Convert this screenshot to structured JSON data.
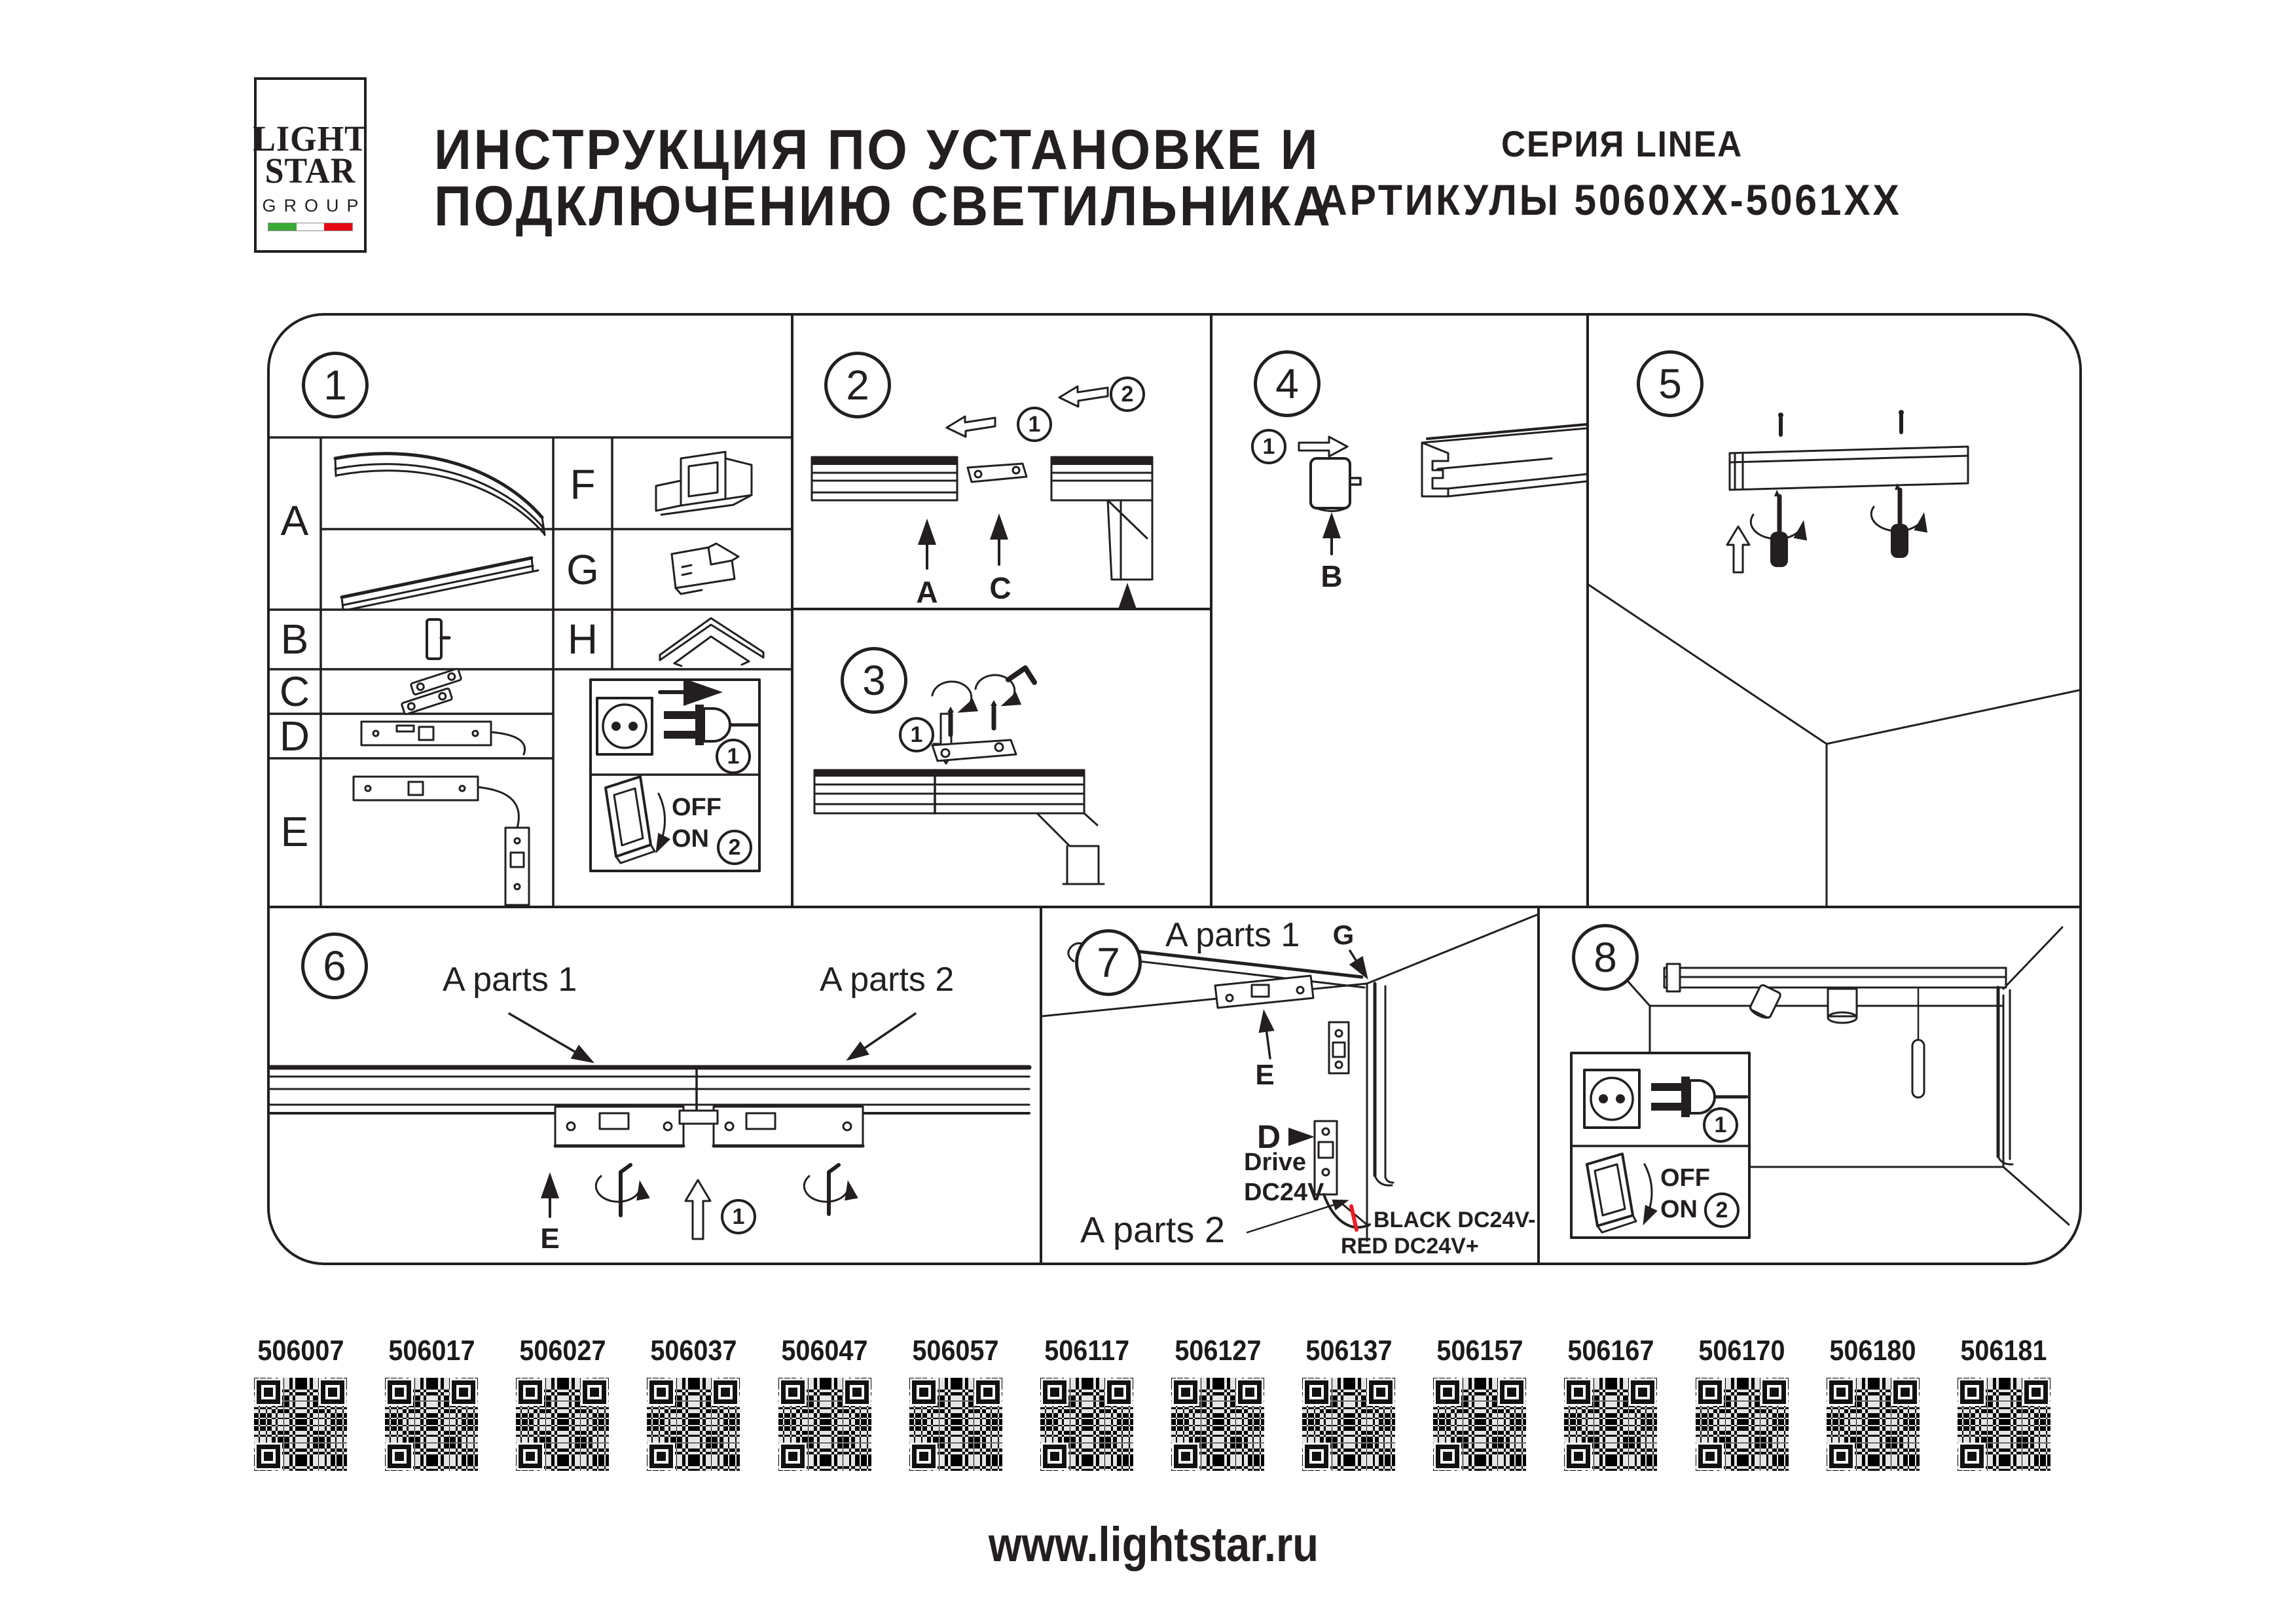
{
  "logo": {
    "light": "LIGHT",
    "star": "STAR",
    "group": "GROUP",
    "flag_green": "#3aaa35",
    "flag_white": "#ffffff",
    "flag_red": "#e30613"
  },
  "header": {
    "title_line1": "ИНСТРУКЦИЯ ПО УСТАНОВКЕ И",
    "title_line2": "ПОДКЛЮЧЕНИЮ СВЕТИЛЬНИКА",
    "series": "СЕРИЯ LINEA",
    "articles": "АРТИКУЛЫ 5060XX-5061XX"
  },
  "steps": {
    "n1": "1",
    "n2": "2",
    "n3": "3",
    "n4": "4",
    "n5": "5",
    "n6": "6",
    "n7": "7",
    "n8": "8"
  },
  "table": {
    "a": "A",
    "b": "B",
    "c": "C",
    "d": "D",
    "e": "E",
    "f": "F",
    "g": "G",
    "h": "H"
  },
  "power_box1": {
    "step_plug": "1",
    "step_switch": "2",
    "off": "OFF",
    "on": "ON"
  },
  "sec2": {
    "step1": "1",
    "step2": "2",
    "label_a": "A",
    "label_c": "C"
  },
  "sec3": {
    "step1": "1"
  },
  "sec4": {
    "step1": "1",
    "label_b": "B"
  },
  "sec6": {
    "a_parts_1": "A parts 1",
    "a_parts_2": "A parts 2",
    "label_e": "E",
    "step1": "1"
  },
  "sec7": {
    "a_parts_1": "A parts 1",
    "label_g": "G",
    "label_e": "E",
    "label_d": "D",
    "drive1": "Drive",
    "drive2": "DC24V",
    "black_wire": "BLACK DC24V-",
    "red_wire": "RED DC24V+",
    "a_parts_2": "A parts 2"
  },
  "power_box8": {
    "step_plug": "1",
    "step_switch": "2",
    "off": "OFF",
    "on": "ON"
  },
  "qr": {
    "items": [
      {
        "label": "506007"
      },
      {
        "label": "506017"
      },
      {
        "label": "506027"
      },
      {
        "label": "506037"
      },
      {
        "label": "506047"
      },
      {
        "label": "506057"
      },
      {
        "label": "506117"
      },
      {
        "label": "506127"
      },
      {
        "label": "506137"
      },
      {
        "label": "506157"
      },
      {
        "label": "506167"
      },
      {
        "label": "506170"
      },
      {
        "label": "506180"
      },
      {
        "label": "506181"
      }
    ]
  },
  "footer": {
    "website": "www.lightstar.ru"
  },
  "colors": {
    "line": "#231f20",
    "accent_red": "#ed1c24"
  }
}
